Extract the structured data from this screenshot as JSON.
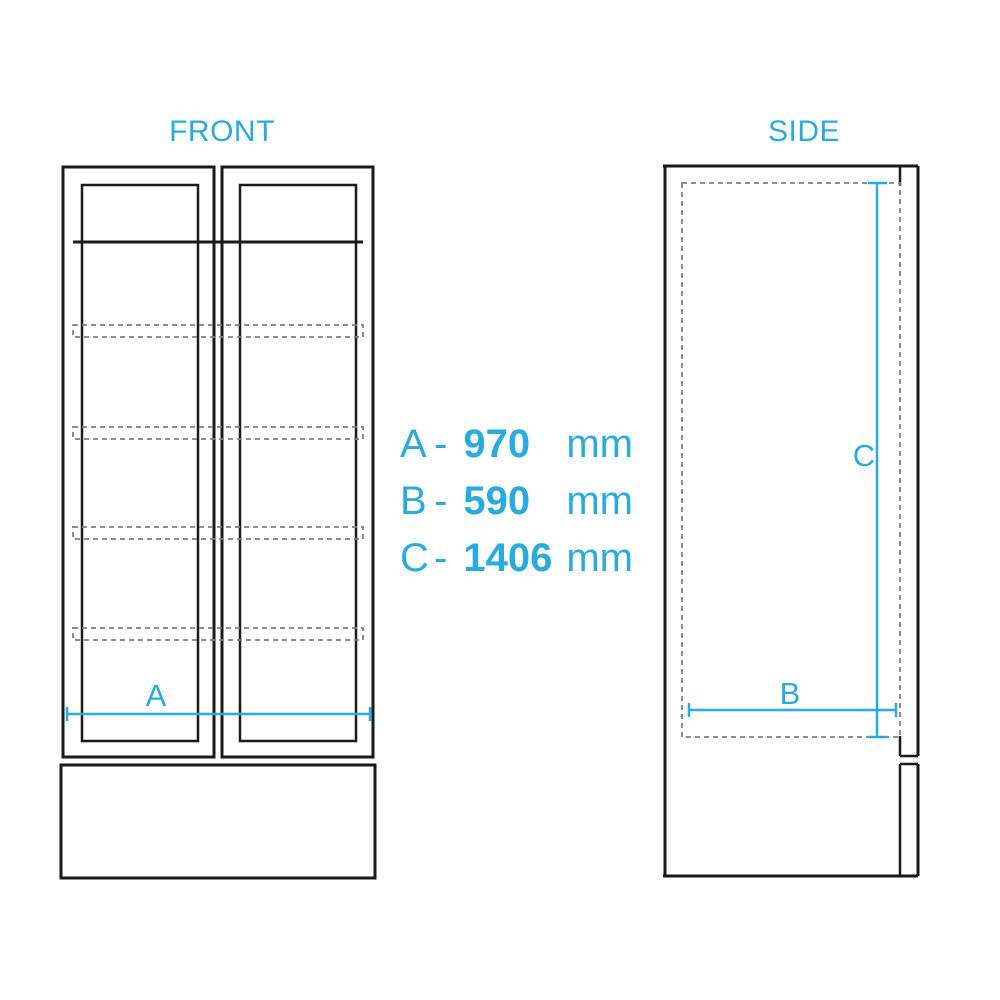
{
  "colors": {
    "accent": "#29ABE2",
    "line": "#1A1A1A",
    "dash": "#7F7F7F",
    "background": "#FFFFFF"
  },
  "views": {
    "front": {
      "title": "FRONT",
      "width_label": "A"
    },
    "side": {
      "title": "SIDE",
      "depth_label": "B",
      "height_label": "C"
    }
  },
  "dimensions": [
    {
      "label": "A",
      "separator": "-",
      "value": "970",
      "unit": "mm"
    },
    {
      "label": "B",
      "separator": "-",
      "value": "590",
      "unit": "mm"
    },
    {
      "label": "C",
      "separator": "-",
      "value": "1406",
      "unit": "mm"
    }
  ]
}
